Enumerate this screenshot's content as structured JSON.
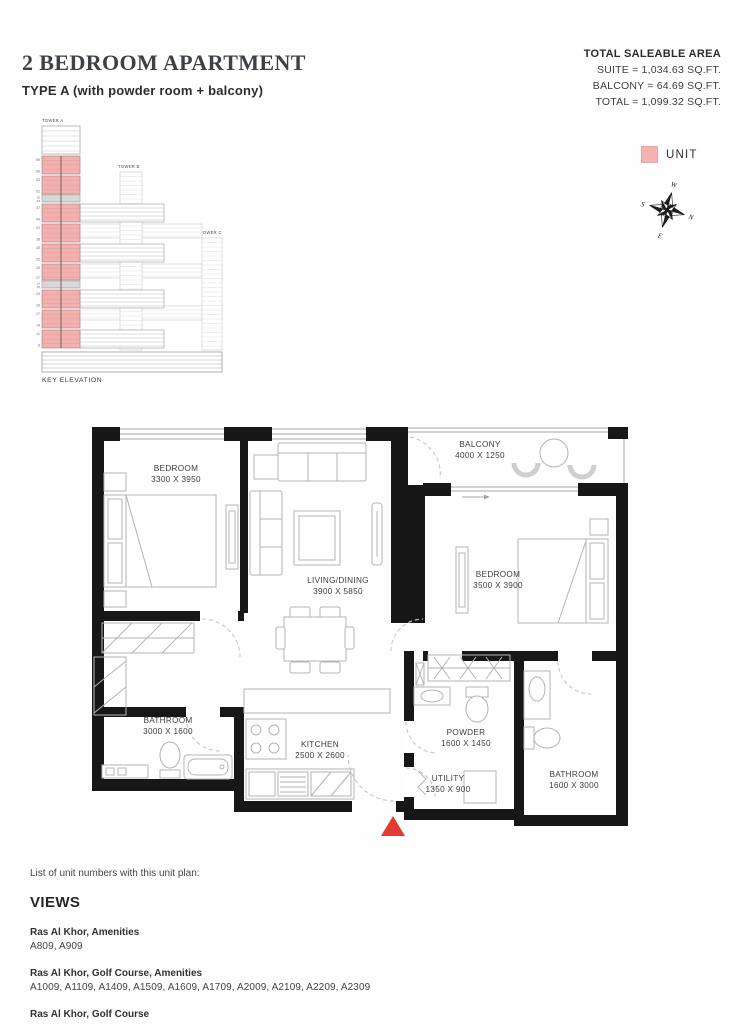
{
  "header": {
    "title": "2 BEDROOM APARTMENT",
    "subtitle": "TYPE A (with powder room + balcony)"
  },
  "area_summary": {
    "heading": "TOTAL SALEABLE AREA",
    "suite": "SUITE = 1,034.63 SQ.FT.",
    "balcony": "BALCONY = 64.69 SQ.FT.",
    "total": "TOTAL = 1,099.32 SQ.FT."
  },
  "legend": {
    "unit_label": "UNIT",
    "unit_color": "#f5b2b0"
  },
  "compass": {
    "north": "N",
    "south": "S",
    "east": "E",
    "west": "W",
    "north_color": "#d6453d"
  },
  "key_elevation": {
    "caption": "KEY ELEVATION",
    "tower_a": "TOWER A",
    "tower_b": "TOWER B",
    "tower_c": "TOWER C",
    "floor_marks": [
      "59",
      "56",
      "53",
      "51",
      "50",
      "49",
      "47",
      "44",
      "41",
      "38",
      "35",
      "32",
      "29",
      "27",
      "26",
      "25",
      "23",
      "20",
      "17",
      "14",
      "11",
      "8"
    ]
  },
  "floor_plan": {
    "entrance_color": "#e23b32",
    "rooms": [
      {
        "name": "BEDROOM",
        "dims": "3300 X 3950"
      },
      {
        "name": "LIVING/DINING",
        "dims": "3900 X 5850"
      },
      {
        "name": "BALCONY",
        "dims": "4000 X 1250"
      },
      {
        "name": "BEDROOM",
        "dims": "3500 X 3900"
      },
      {
        "name": "BATHROOM",
        "dims": "3000 X 1600"
      },
      {
        "name": "KITCHEN",
        "dims": "2500 X 2600"
      },
      {
        "name": "POWDER",
        "dims": "1600 X 1450"
      },
      {
        "name": "UTILITY",
        "dims": "1350 X 900"
      },
      {
        "name": "BATHROOM",
        "dims": "1600 X 3000"
      }
    ]
  },
  "unit_list": {
    "intro": "List of unit numbers with this unit plan:",
    "heading": "VIEWS",
    "groups": [
      {
        "view": "Ras Al Khor, Amenities",
        "units": "A809, A909"
      },
      {
        "view": "Ras Al Khor, Golf Course, Amenities",
        "units": "A1009, A1109, A1409, A1509, A1609, A1709, A2009, A2109, A2209, A2309"
      },
      {
        "view": "Ras Al Khor, Golf Course",
        "units": "A2709, A2809, A2909, A3209, A3309, A3409, A3509, A3809, A3909, A4009, A4109, A4409, A4509, A4609, A4709, A5110, A5210, A5310, A5610, A5710, A5810, A5910"
      }
    ]
  }
}
